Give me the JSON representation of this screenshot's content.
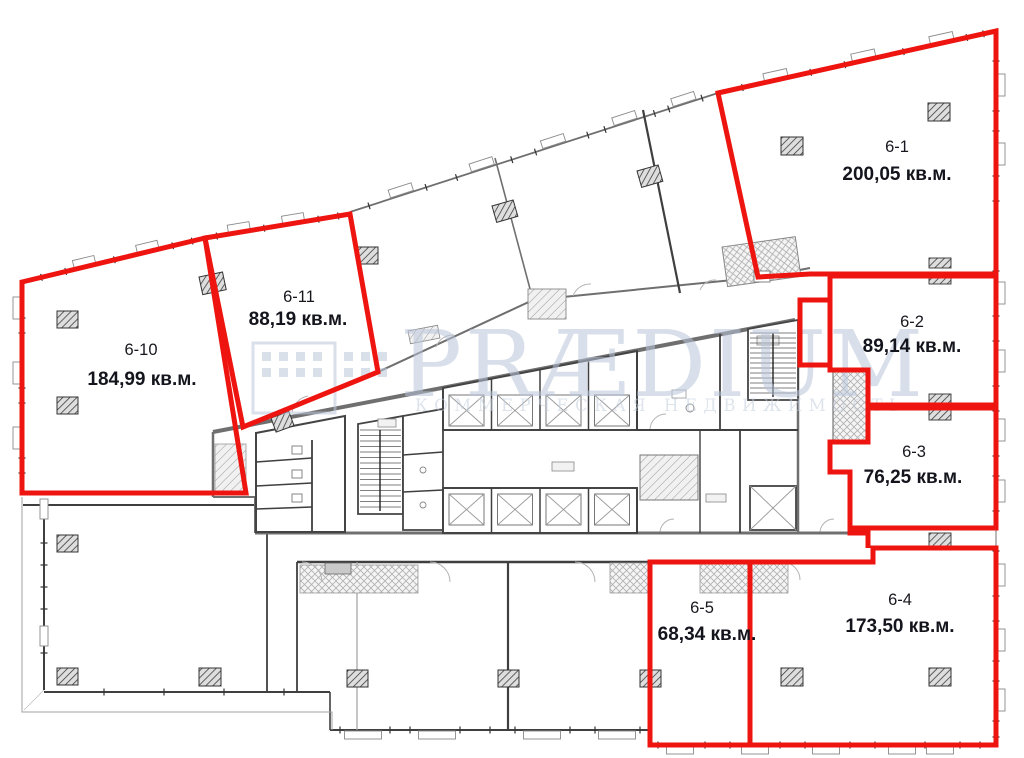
{
  "plan": {
    "units": [
      {
        "id": "6-1",
        "area": "200,05 кв.м."
      },
      {
        "id": "6-2",
        "area": "89,14 кв.м."
      },
      {
        "id": "6-3",
        "area": "76,25 кв.м."
      },
      {
        "id": "6-4",
        "area": "173,50 кв.м."
      },
      {
        "id": "6-5",
        "area": "68,34 кв.м."
      },
      {
        "id": "6-10",
        "area": "184,99 кв.м."
      },
      {
        "id": "6-11",
        "area": "88,19 кв.м."
      }
    ],
    "watermark": {
      "brand": "PRÆDIUM",
      "subtitle": "КОММЕРЧЕСКАЯ НЕДВИЖИМОСТЬ"
    },
    "colors": {
      "unit_outline": "#ee1511",
      "unit_label": "#14141d",
      "watermark": "#b9c6da",
      "wall_dark": "#3f3f3f",
      "wall_light": "#a0a0a0"
    }
  }
}
